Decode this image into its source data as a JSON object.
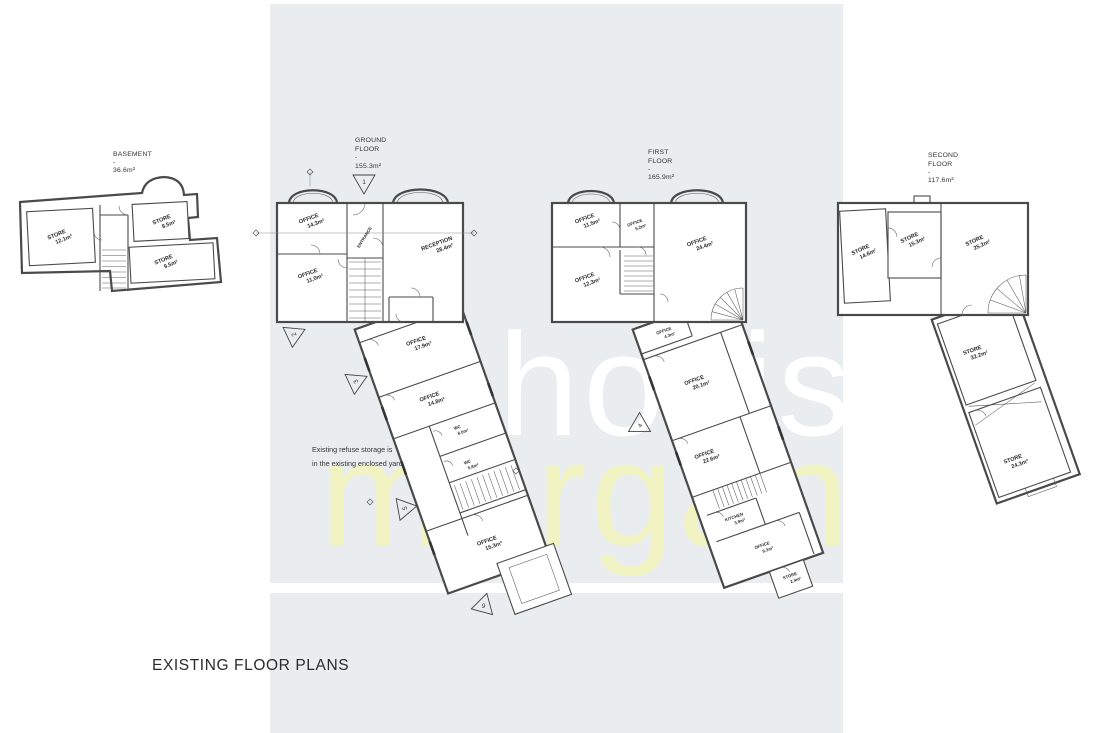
{
  "page": {
    "title": "EXISTING FLOOR PLANS"
  },
  "watermark": {
    "line1": "hollis",
    "line2": "morgan",
    "color1": "#ffffff",
    "color2": "#f1f3c2"
  },
  "colors": {
    "band": "#e9edf0",
    "wall": "#4a4a4a",
    "text": "#2a2a2a"
  },
  "annotations": {
    "refuse1": "Existing refuse storage is",
    "refuse2": "in the existing enclosed yard"
  },
  "plans": {
    "basement": {
      "title": [
        "BASEMENT",
        "-",
        "36.6m²"
      ],
      "rooms": [
        {
          "n": "STORE",
          "a": "12.1m²"
        },
        {
          "n": "STORE",
          "a": "8.5m²"
        },
        {
          "n": "STORE",
          "a": "9.5m²"
        }
      ]
    },
    "ground": {
      "title": [
        "GROUND",
        "FLOOR",
        "-",
        "155.3m²"
      ],
      "markers": [
        "1",
        "2",
        "3",
        "5",
        "9"
      ],
      "rooms": [
        {
          "n": "OFFICE",
          "a": "14.3m²"
        },
        {
          "n": "ENTRANCE",
          "a": ""
        },
        {
          "n": "RECEPTION",
          "a": "28.4m²"
        },
        {
          "n": "OFFICE",
          "a": "11.0m²"
        },
        {
          "n": "OFFICE",
          "a": "17.9m²"
        },
        {
          "n": "OFFICE",
          "a": "14.8m²"
        },
        {
          "n": "WC",
          "a": "6.0m²"
        },
        {
          "n": "WC",
          "a": "5.8m²"
        },
        {
          "n": "OFFICE",
          "a": "15.3m²"
        }
      ]
    },
    "first": {
      "title": [
        "FIRST",
        "FLOOR",
        "-",
        "165.9m²"
      ],
      "markers": [
        "4"
      ],
      "rooms": [
        {
          "n": "OFFICE",
          "a": "11.5m²"
        },
        {
          "n": "OFFICE",
          "a": "5.2m²"
        },
        {
          "n": "OFFICE",
          "a": "24.4m²"
        },
        {
          "n": "OFFICE",
          "a": "12.3m²"
        },
        {
          "n": "OFFICE",
          "a": "4.3m²"
        },
        {
          "n": "OFFICE",
          "a": "20.1m²"
        },
        {
          "n": "OFFICE",
          "a": "22.6m²"
        },
        {
          "n": "KITCHEN",
          "a": "3.9m²"
        },
        {
          "n": "OFFICE",
          "a": "9.3m²"
        },
        {
          "n": "STORE",
          "a": "2.4m²"
        }
      ]
    },
    "second": {
      "title": [
        "SECOND",
        "FLOOR",
        "-",
        "117.6m²"
      ],
      "rooms": [
        {
          "n": "STORE",
          "a": "14.6m²"
        },
        {
          "n": "STORE",
          "a": "15.3m²"
        },
        {
          "n": "STORE",
          "a": "25.2m²"
        },
        {
          "n": "STORE",
          "a": "32.2m²"
        },
        {
          "n": "STORE",
          "a": "24.3m²"
        }
      ]
    }
  }
}
